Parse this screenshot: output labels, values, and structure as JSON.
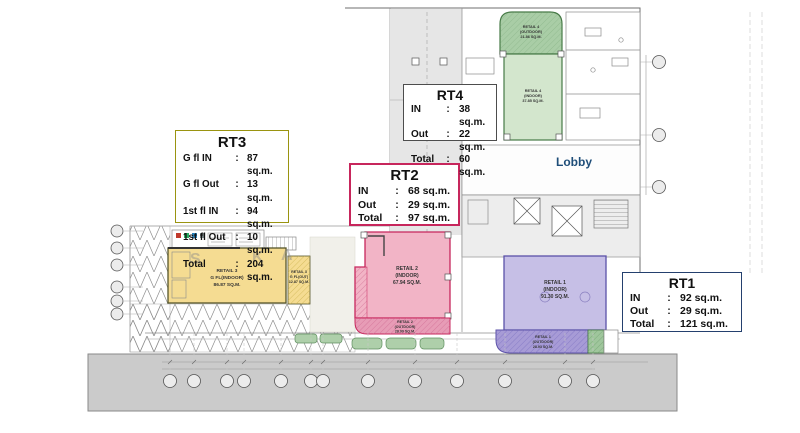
{
  "legend_boxes": {
    "rt1": {
      "title": "RT1",
      "rows": [
        {
          "label": "IN",
          "colon": ":",
          "value": "92 sq.m."
        },
        {
          "label": "Out",
          "colon": ":",
          "value": "29 sq.m."
        },
        {
          "label": "Total",
          "colon": ":",
          "value": "121 sq.m."
        }
      ]
    },
    "rt2": {
      "title": "RT2",
      "rows": [
        {
          "label": "IN",
          "colon": ":",
          "value": "68 sq.m."
        },
        {
          "label": "Out",
          "colon": ":",
          "value": "29 sq.m."
        },
        {
          "label": "Total",
          "colon": ":",
          "value": "97 sq.m."
        }
      ]
    },
    "rt3": {
      "title": "RT3",
      "rows": [
        {
          "label": "G fl IN",
          "colon": ":",
          "value": "87 sq.m."
        },
        {
          "label": "G fl Out",
          "colon": ":",
          "value": "13 sq.m."
        },
        {
          "label": "1st fl IN",
          "colon": ":",
          "value": "94 sq.m."
        },
        {
          "label": "1st fl Out",
          "colon": ":",
          "value": "10 sq.m."
        },
        {
          "label": "Total",
          "colon": ":",
          "value": "204 sq.m."
        }
      ]
    },
    "rt4": {
      "title": "RT4",
      "rows": [
        {
          "label": "IN",
          "colon": ":",
          "value": "38 sq.m."
        },
        {
          "label": "Out",
          "colon": ":",
          "value": "22 sq.m."
        },
        {
          "label": "Total",
          "colon": ":",
          "value": "60 sq.m."
        }
      ]
    }
  },
  "plan": {
    "lobby_label": "Lobby",
    "watermark": [
      "S",
      "K",
      "A"
    ],
    "zones": {
      "retail4_outdoor": {
        "name": "RETAIL 4",
        "type": "(OUTDOOR)",
        "area": "21.86 SQ.M."
      },
      "retail4_indoor": {
        "name": "RETAIL 4",
        "type": "(INDOOR)",
        "area": "37.85 SQ.M."
      },
      "retail1_indoor": {
        "name": "RETAIL 1",
        "type": "(INDOOR)",
        "area": "91.30 SQ.M."
      },
      "retail1_outdoor": {
        "name": "RETAIL 1",
        "type": "(OUTDOOR)",
        "area": "28.93 SQ.M."
      },
      "retail2_indoor": {
        "name": "RETAIL 2",
        "type": "(INDOOR)",
        "area": "67.94 SQ.M."
      },
      "retail2_outdoor": {
        "name": "RETAIL 2",
        "type": "(OUTDOOR)",
        "area": "28.99 SQ.M."
      },
      "retail3_indoor": {
        "name": "RETAIL 3",
        "type": "G FL(INDOOR)",
        "area": "86.87 SQ.M."
      },
      "retail3_outdoor": {
        "name": "RETAIL 3",
        "type": "G FL(OUT)",
        "area": "12.87 SQ.M."
      }
    }
  },
  "colors": {
    "retail4_outdoor_fill": "#a9cda6",
    "retail4_indoor_fill": "#d3e6cd",
    "retail1_indoor_fill": "#c6bfe6",
    "retail1_outdoor_fill": "#a79bd6",
    "retail2_indoor_fill": "#f2b4c6",
    "retail2_outdoor_fill": "#e79cb6",
    "retail3_fill": "#f5dc92",
    "rt1_border": "#24406e",
    "rt2_border": "#c7265c",
    "rt3_border": "#9a9410",
    "lobby_text": "#1f4e79",
    "road_grey": "#cbcbcb"
  }
}
